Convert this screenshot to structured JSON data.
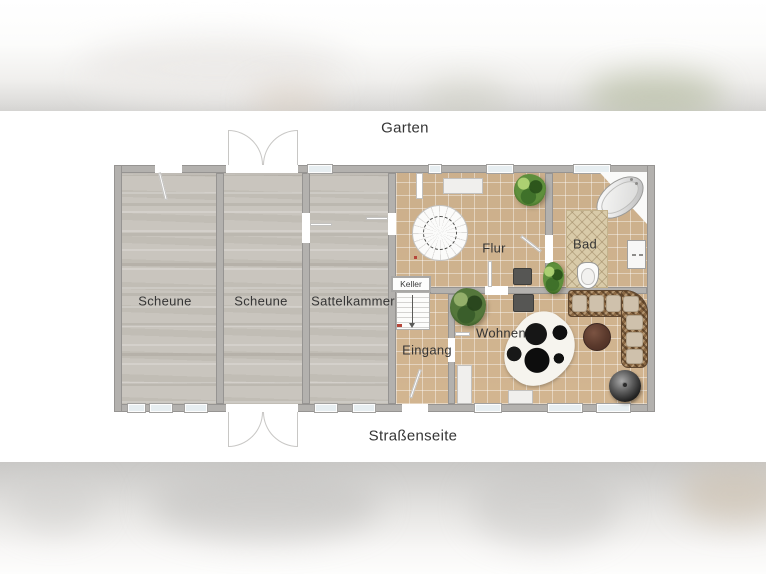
{
  "scene": {
    "kind": "residential floor plan (ground floor), letterboxed over blurred photo background"
  },
  "labels": {
    "garden_side": "Garten",
    "street_side": "Straßenseite"
  },
  "rooms": {
    "scheune1": "Scheune",
    "scheune2": "Scheune",
    "sattelkammer": "Sattelkammer",
    "flur": "Flur",
    "bad": "Bad",
    "keller": "Keller",
    "eingang": "Eingang",
    "wohnen": "Wohnen"
  },
  "furniture": [
    "spiral-staircase",
    "cellar-stairs",
    "corner-bathtub",
    "bath-rug",
    "toilet",
    "sink",
    "potted-plant-flur",
    "potted-plant-wohnen",
    "potted-plant-bad",
    "rattan-corner-sofa",
    "round-coffee-table",
    "wood-stove",
    "cowhide-rug",
    "wardrobe",
    "sideboard",
    "hall-cabinet",
    "chimney-block",
    "double-swing-door-garden",
    "double-swing-door-street"
  ],
  "colors": {
    "wall_gray": "#b3b1ae",
    "tile_floor": "#d2b590",
    "concrete_floor": "#c7c3bc",
    "window_blue": "#e7eef1",
    "plant_green": "#5e8f3c",
    "sofa_wicker": "#8a6844",
    "cushion_beige": "#cfc1ac",
    "table_brown": "#5a392c",
    "label_text": "#353535"
  }
}
